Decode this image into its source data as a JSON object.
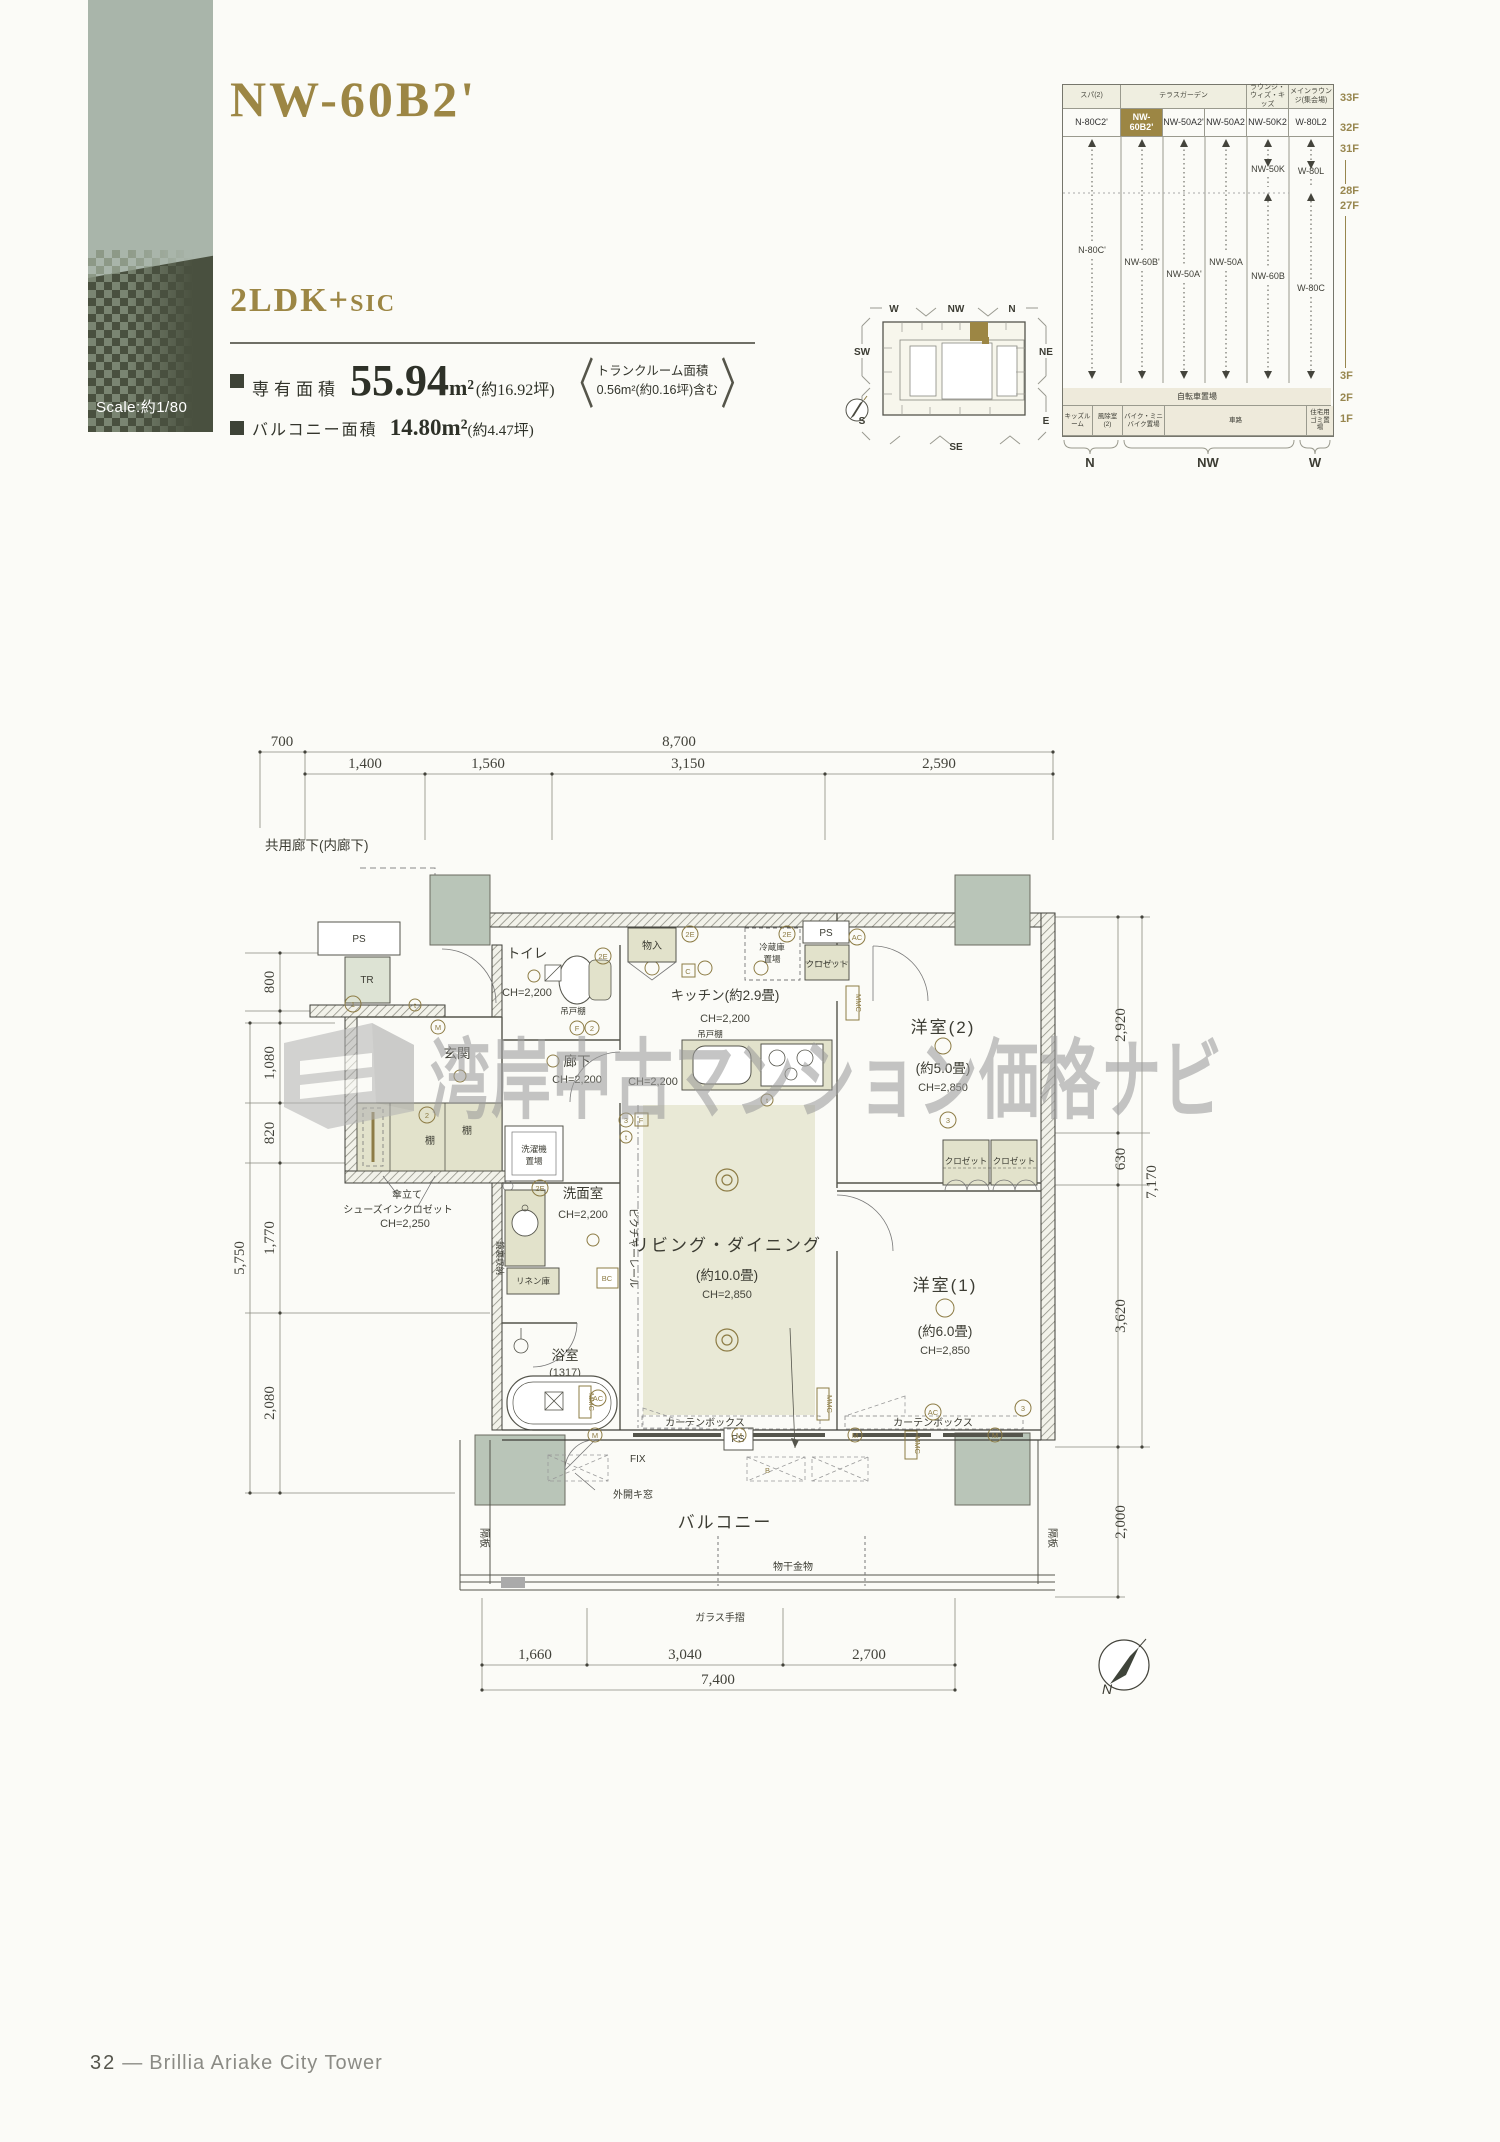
{
  "page": {
    "title": "NW-60B2'",
    "scale_label": "Scale:約1/80",
    "footer_number": "32",
    "footer_dash": "—",
    "footer_title": "Brillia Ariake City Tower"
  },
  "unit": {
    "type_main": "2LDK+",
    "type_suffix": "SIC",
    "area_label": "専有面積",
    "area_value": "55.94",
    "area_unit": "m²",
    "area_tsubo": "(約16.92坪)",
    "bracket_open": "〈",
    "bracket_close": "〉",
    "trunk_line1": "トランクルーム面積",
    "trunk_line2": "0.56m²(約0.16坪)含む",
    "balcony_label": "バルコニー面積",
    "balcony_value": "14.80m²",
    "balcony_tsubo": "(約4.47坪)"
  },
  "keyplan": {
    "dirs": {
      "w": "W",
      "nw": "NW",
      "n": "N",
      "sw": "SW",
      "ne": "NE",
      "s": "S",
      "e": "E",
      "se": "SE"
    },
    "compass_n": "N"
  },
  "section": {
    "headers": [
      "スパ(2)",
      "テラスガーデン",
      "ラウンジ・ウィズ・キッズ",
      "メインラウンジ(集会場)"
    ],
    "units": [
      "N-80C2'",
      "NW-60B2'",
      "NW-50A2'",
      "NW-50A2",
      "NW-50K2",
      "W-80L2"
    ],
    "mid_units": {
      "c1": "N-80C'",
      "c2": "NW-60B'",
      "c3": "NW-50A'",
      "c4": "NW-50A",
      "c5a": "NW-50K",
      "c5b": "NW-60B",
      "c6a": "W-80L",
      "c6b": "W-80C"
    },
    "floors": [
      "33F",
      "32F",
      "31F",
      "28F",
      "27F",
      "3F",
      "2F",
      "1F"
    ],
    "bike_row": "自転車置場",
    "bottom_cells": [
      "キッズルーム",
      "風除室(2)",
      "バイク・ミニバイク置場",
      "車路",
      "住宅用ゴミ置場"
    ],
    "base_dirs": [
      "N",
      "NW",
      "W"
    ]
  },
  "plan": {
    "corridor": "共用廊下(内廊下)",
    "dims": {
      "t700": "700",
      "t8700": "8,700",
      "t1400": "1,400",
      "t1560": "1,560",
      "t3150": "3,150",
      "t2590": "2,590",
      "l800": "800",
      "l1080": "1,080",
      "l820": "820",
      "l5750": "5,750",
      "l1770": "1,770",
      "l2080": "2,080",
      "r2920": "2,920",
      "r630": "630",
      "r7170": "7,170",
      "r3620": "3,620",
      "r2000": "2,000",
      "b1660": "1,660",
      "b3040": "3,040",
      "b2700": "2,700",
      "b7400": "7,400"
    },
    "rooms": {
      "toilet": "トイレ",
      "toilet_ch": "CH=2,200",
      "kitchen": "キッチン(約2.9畳)",
      "kitchen_ch": "CH=2,200",
      "kitchen_ch2": "CH=2,200",
      "bed2": "洋室(2)",
      "bed2_size": "(約5.0畳)",
      "bed2_ch": "CH=2,850",
      "genkan": "玄関",
      "hall": "廊下",
      "hall_ch": "CH=2,200",
      "wash": "洗面室",
      "wash_ch": "CH=2,200",
      "ld": "リビング・ダイニング",
      "ld_size": "(約10.0畳)",
      "ld_ch": "CH=2,850",
      "bed1": "洋室(1)",
      "bed1_size": "(約6.0畳)",
      "bed1_ch": "CH=2,850",
      "bath": "浴室",
      "bath_size": "(1317)",
      "balcony": "バルコニー"
    },
    "labels": {
      "ps": "PS",
      "tr": "TR",
      "monoire": "物入",
      "fridge1": "冷蔵庫",
      "fridge2": "置場",
      "closet": "クロゼット",
      "mmc": "MMC",
      "tsuridana": "吊戸棚",
      "tana": "棚",
      "kasatate": "傘立て",
      "sic": "シューズインクロゼット",
      "sic_ch": "CH=2,250",
      "washer1": "洗濯機",
      "washer2": "置場",
      "kagamiura": "鏡裏収納",
      "linen": "リネン庫",
      "bc": "BC",
      "picture_rail": "ピクチャーレール",
      "curtain": "カーテンボックス",
      "fix": "FIX",
      "sotobiraki": "外開キ窓",
      "kakuita": "隔板",
      "monohoshi": "物干金物",
      "glass": "ガラス手摺",
      "b": "B",
      "c": "C",
      "f": "F",
      "m": "M",
      "t": "t",
      "ac": "AC",
      "e2": "2E",
      "n1": "1",
      "n2": "2",
      "n3": "3",
      "compass_n": "N"
    }
  },
  "watermark": {
    "text": "湾岸中古マンション価格ナビ"
  }
}
